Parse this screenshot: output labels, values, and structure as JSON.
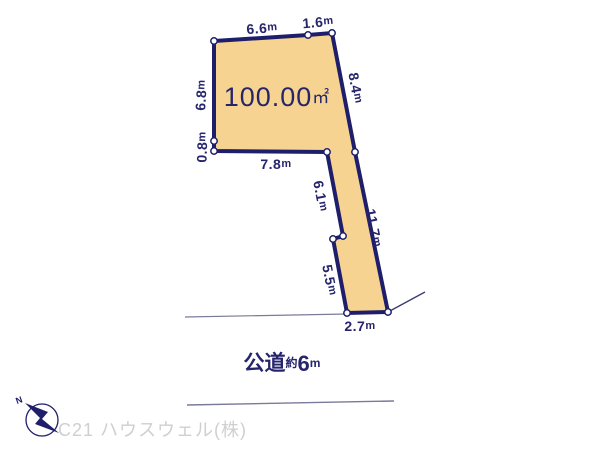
{
  "plot": {
    "area": {
      "value": "100.00",
      "unit": "㎡"
    },
    "dimensions": [
      {
        "name": "top-left-edge",
        "value": "6.6",
        "unit": "m"
      },
      {
        "name": "top-right-edge",
        "value": "1.6",
        "unit": "m"
      },
      {
        "name": "upper-right-edge",
        "value": "8.4",
        "unit": "m"
      },
      {
        "name": "left-edge",
        "value": "6.8",
        "unit": "m"
      },
      {
        "name": "lower-left-edge",
        "value": "0.8",
        "unit": "m"
      },
      {
        "name": "inner-bottom-edge",
        "value": "7.8",
        "unit": "m"
      },
      {
        "name": "strip-upper-left-edge",
        "value": "6.1",
        "unit": "m"
      },
      {
        "name": "strip-right-edge",
        "value": "11.7",
        "unit": "m"
      },
      {
        "name": "strip-lower-left-edge",
        "value": "5.5",
        "unit": "m"
      },
      {
        "name": "bottom-road-edge",
        "value": "2.7",
        "unit": "m"
      }
    ],
    "colors": {
      "fill": "#F6D391",
      "outline": "#1E1E6B",
      "label": "#26256B"
    }
  },
  "road": {
    "label_prefix": "公道",
    "label_approx": "約",
    "label_value": "6",
    "label_unit": "m"
  },
  "compass": {
    "north_label": "N"
  },
  "footer": {
    "company": "C21 ハウスウェル(株)",
    "color": "#CFCFCF"
  }
}
